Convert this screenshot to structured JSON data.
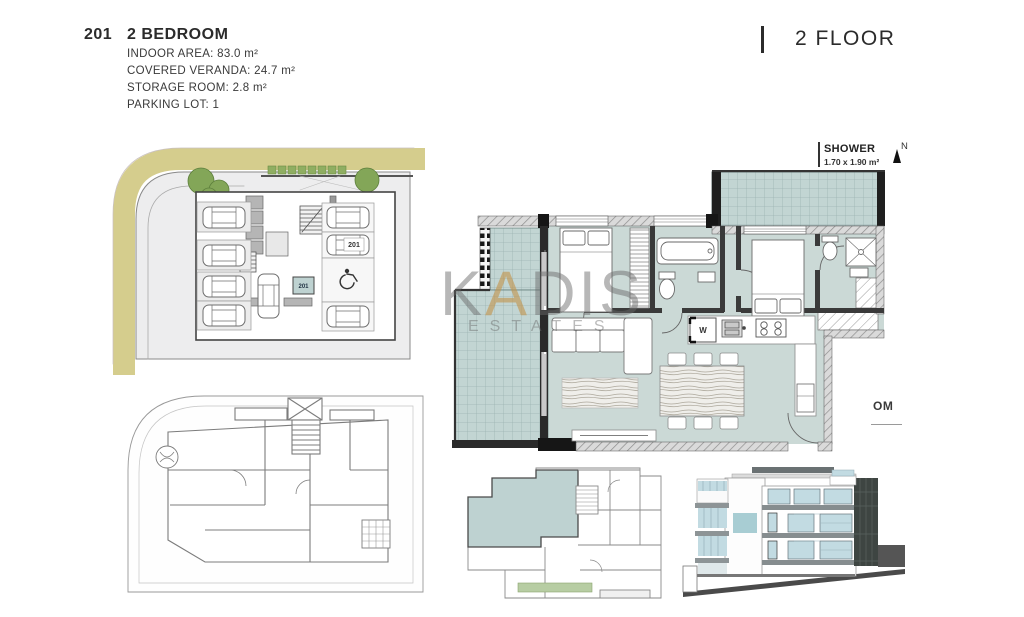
{
  "header": {
    "unit_number": "201",
    "unit_type": "2 BEDROOM",
    "detail_lines": [
      "INDOOR AREA: 83.0 m²",
      "COVERED VERANDA: 24.7 m²",
      "STORAGE ROOM: 2.8 m²",
      "PARKING LOT: 1"
    ],
    "floor_label": "2 FLOOR"
  },
  "annotations": {
    "shower_label": "SHOWER",
    "shower_dims": "1.70 x 1.90 m²",
    "north_letter": "N",
    "partial_room_label": "OM",
    "parking_number": "201",
    "storage_number": "201",
    "washer_label": "W"
  },
  "watermark": {
    "brand_k": "K",
    "brand_a": "A",
    "brand_dis": "DIS",
    "sub": "ESTATES"
  },
  "colors": {
    "floor_teal": "#cbd9d6",
    "veranda_teal": "#c2d5d3",
    "road_olive": "#d5cd8d",
    "tree_green": "#83a658",
    "key_highlight": "#bed2d1",
    "garden_green": "#b7cda3",
    "elevation_glass": "#c2dbe2",
    "elevation_dark": "#3e4542",
    "wall_dark": "#2a2a2a",
    "watermark_gold": "#c1944d"
  }
}
